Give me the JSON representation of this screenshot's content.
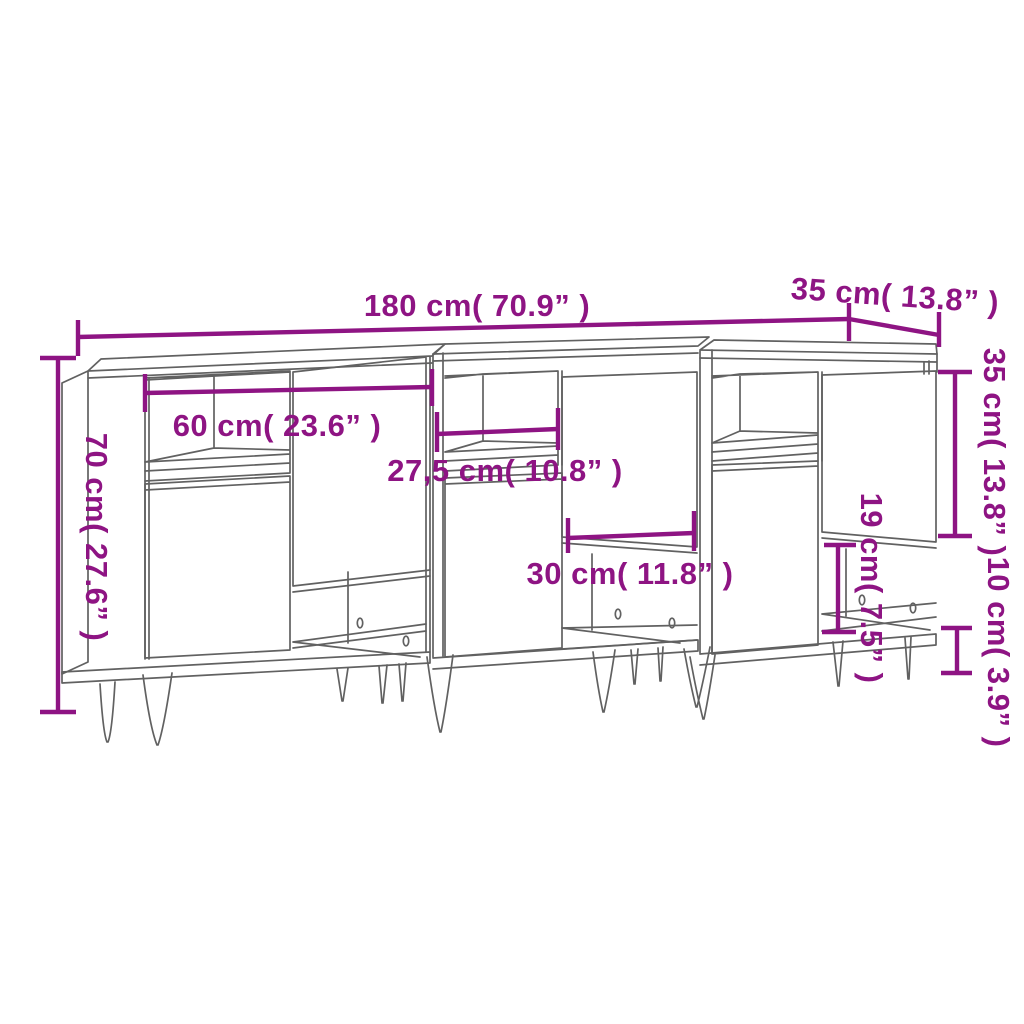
{
  "diagram": {
    "accent_color": "#8E1483",
    "line_color": "#616161",
    "background": "#ffffff",
    "dims": {
      "width_total": "180 cm( 70.9” )",
      "depth_top": "35 cm( 13.8” )",
      "height_total": "70 cm( 27.6” )",
      "inner_width_left": "60 cm( 23.6” )",
      "inner_width_middle": "27,5 cm( 10.8” )",
      "door_width": "30 cm( 11.8” )",
      "open_compartment_height": "19 cm( 7.5” )",
      "door_height": "35 cm( 13.8” )",
      "leg_clearance": "10 cm( 3.9” )"
    }
  }
}
